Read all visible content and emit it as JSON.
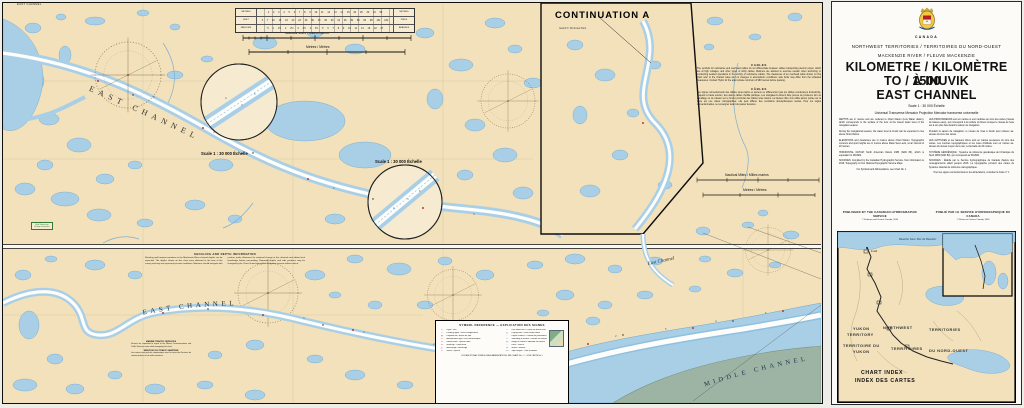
{
  "colors": {
    "land": "#f2e1ba",
    "water": "#a9cfe7",
    "water_edge": "#6fa5c9",
    "channel_white": "#fdfdfb",
    "island_green": "#9db4a4",
    "border_black": "#101010",
    "light_red": "#c0392b",
    "note_green": "#2e7d32"
  },
  "main_chart": {
    "edge_note": "EAST CHANNEL",
    "continuation_label": "CONTINUATION A",
    "park_label": "Gwich'in Territorial Park",
    "channel_labels": {
      "top": "EAST CHANNEL",
      "bottom": "EAST CHANNEL",
      "bottom_small": "East Channel",
      "middle": "MIDDLE CHANNEL"
    },
    "magnifier_label_1": "Scale 1 : 30 000 Échelle",
    "magnifier_label_2": "Scale 1 : 30 000 Échelle",
    "scalebar_nm": "Nautical Miles / Milles marins",
    "scalebar_m": "Metres / Mètres",
    "conversion_table": {
      "rows": [
        {
          "left": "METRES",
          "cells": "1 2 3 4 5 6 7 8 9 10 11 12 13 14 15 20 25 30 40 50",
          "right": "METRES"
        },
        {
          "left": "FEET",
          "cells": "3 7 10 13 16 20 23 26 30 33 36 39 43 46 49 66 82 98 131 164",
          "right": "PIEDS"
        },
        {
          "left": "FATHOMS",
          "cells": "½ 1 1½ 2 2½ 3 3½ 4 4½ 5 6 7 8 9 10 11 14 16 22 27",
          "right": "BRASSES"
        }
      ]
    },
    "cables": {
      "title_en": "CABLES",
      "body_en": "The symbols for submarine and overhead cables do not differentiate between cables transporting electric power, which are at high voltages, and other types of utility cables. Mariners are advised to exercise caution when anchoring or conducting seabed operations in the vicinity of submarine cables. The clearances of an overhead cable shown on this chart refer to the charted value and no changes in atmospheric conditions; safe limits may differ from the indicated clearances. Contact Hydro for the approximate minimum of 999 metres before passing.",
      "title_fr": "CÂBLES",
      "body_fr": "Les signes conventionnels des câbles sous-marins et aériens ne différencient pas les câbles conducteurs d'électricité, lesquels à haute tension, des autres câbles d'utilité publique. Les navigateurs doivent faire preuve de prudence lors du mouillage ou de travaux sur le fond à proximité des câbles sous-marins. La hauteur libre d'un câble aérien portée sur la carte est une valeur cartographiée; elle peut différer des conditions atmosphériques réelles. Pour les règles conventionnelles, se renseigner avant de passer dessous."
    },
    "notes": {
      "shoaling_title": "SHOALING AND DEPTH INFORMATION",
      "shoaling_body": "Shoaling and frequent variations in the Mackenzie River channel depths can be expected. The depths shown on this chart were obtained at the time of the survey and may not represent present conditions. Mariners should navigate with caution, make allowance for continual change in the channels and obtain local knowledge before proceeding. Reported depths and aids positions may be changed by the Coast Guard during the navigation season without notice.",
      "traffic_title_en": "MARINE TRAFFIC SERVICES",
      "traffic_body_en": "Vessels are requested to report to the Marine Communications and Traffic Services centre while navigating this chart.",
      "traffic_title_fr": "SERVICES DU TRAFIC MARITIME",
      "traffic_body_fr": "Les navires sont priés de communiquer avec le centre des Services de communications et de trafic maritimes."
    },
    "green_box_line1": "Bird Sanctuary",
    "green_box_line2": "Refuge d'oiseaux",
    "legend": {
      "title": "SYMBOL REFERENCE — EXPLICATION DES SIGNES",
      "left": [
        {
          "s": "✶",
          "t": "Light / Feu"
        },
        {
          "s": "⌖",
          "t": "Leading lights / Feux d'alignement"
        },
        {
          "s": "▮",
          "t": "Daybeacon / Balise de jour"
        },
        {
          "s": "✈",
          "t": "Aeronautical light / Feu aéronautique"
        },
        {
          "s": "⚑",
          "t": "Radio mast / Pylône radio"
        },
        {
          "s": "●",
          "t": "Mooring / Corps-mort"
        },
        {
          "s": "⚓",
          "t": "Anchorage / Mouillage"
        },
        {
          "s": "✕",
          "t": "Wreck / Épave"
        }
      ],
      "right": [
        {
          "s": "—",
          "t": "Low water line / Laisse de basse mer"
        },
        {
          "s": "▒",
          "t": "Drying area / Zone asséchante"
        },
        {
          "s": "~",
          "t": "Depth contour / Courbe de profondeur"
        },
        {
          "s": "9",
          "t": "Sounding in metres / Sonde en mètres"
        },
        {
          "s": "(3)",
          "t": "Height in metres / Altitude en mètres"
        },
        {
          "s": "＊",
          "t": "Rock / Roche"
        },
        {
          "s": "ψ",
          "t": "Marsh / Marais"
        },
        {
          "s": "·127",
          "t": "Spot height / Cote d'altitude"
        }
      ],
      "footer": "FOR ADDITIONAL SYMBOLS AND ABBREVIATIONS, SEE CHART No. 1 — VOIR CARTE No 1"
    },
    "soundings": [
      {
        "x": 222,
        "y": 96,
        "v": "4"
      },
      {
        "x": 238,
        "y": 103,
        "v": "3"
      },
      {
        "x": 251,
        "y": 92,
        "v": "5"
      },
      {
        "x": 390,
        "y": 206,
        "v": "4"
      },
      {
        "x": 404,
        "y": 197,
        "v": "3"
      },
      {
        "x": 416,
        "y": 189,
        "v": "6"
      },
      {
        "x": 150,
        "y": 95,
        "v": "3"
      },
      {
        "x": 210,
        "y": 130,
        "v": "4"
      },
      {
        "x": 330,
        "y": 186,
        "v": "2"
      },
      {
        "x": 470,
        "y": 212,
        "v": "4"
      },
      {
        "x": 300,
        "y": 316,
        "v": "3"
      },
      {
        "x": 360,
        "y": 330,
        "v": "4"
      },
      {
        "x": 430,
        "y": 342,
        "v": "2"
      },
      {
        "x": 520,
        "y": 350,
        "v": "3"
      },
      {
        "x": 562,
        "y": 342,
        "v": "4"
      },
      {
        "x": 612,
        "y": 334,
        "v": "2"
      },
      {
        "x": 662,
        "y": 327,
        "v": "5"
      },
      {
        "x": 712,
        "y": 319,
        "v": "4"
      },
      {
        "x": 762,
        "y": 311,
        "v": "6"
      }
    ]
  },
  "title_panel": {
    "country": "CANADA",
    "territory": "NORTHWEST TERRITORIES / TERRITOIRES DU NORD-OUEST",
    "river": "MACKENZIE RIVER / FLEUVE MACKENZIE",
    "title_line1": "KILOMETRE / KILOMÈTRE 1500",
    "title_line2": "TO / À INUVIK",
    "title_line3": "EAST CHANNEL",
    "scale": "Scale 1 : 30 000 Échelle",
    "projection": "Universal Transverse Mercator Projection    Mercator transverse universelle",
    "paras_en": [
      "DEPTHS are in metres and are reduced to Chart Datum (Low Water datum), which corresponds to the surface of the river at the lowest water level of the navigation season.",
      "During the navigational season, the water level at Inuvik can be expected to rise above Chart Datum.",
      "ELEVATIONS and clearances are in metres above Chart Datum. Topographic contours and spot heights are in metres above Mean Sea Level, at an interval of 20 metres."
    ],
    "datum_en": "HORIZONTAL DATUM: North American Datum 1983 (NAD 83), which is equivalent to WGS84.",
    "sources_en": "SOURCES: Compiled by the Canadian Hydrographic Service, from information to 2016. Topography is from National Topographic Service Maps.",
    "symbols_en": "For Symbols and Abbreviations, see Chart No. 1",
    "paras_fr": [
      "LES PROFONDEURS sont en mètres et sont réduites au zéro des cartes (niveau de basses eaux), qui correspond à la surface du fleuve lorsque le niveau de l'eau est à son plus bas durant la saison de navigation.",
      "Pendant la saison de navigation, le niveau de l'eau à Inuvik peut s'élever au-dessus du zéro des cartes.",
      "LES ALTITUDES et les hauteurs libres sont en mètres au-dessus du zéro des cartes. Les courbes topographiques et les cotes d'altitude sont en mètres au-dessus du niveau moyen de la mer, à intervalle de 20 mètres."
    ],
    "datum_fr": "SYSTÈME GÉODÉSIQUE : Système de référence géodésique de l'Amérique du Nord 1983 (NAD 83), qui correspond au WGS84.",
    "sources_fr": "SOURCES : Établie par le Service hydrographique du Canada d'après des renseignements allant jusqu'à 2016. La topographie provient des cartes du Système national de référence cartographique.",
    "symbols_fr": "Pour les signes conventionnels et les abréviations, consulter la Carte n° 1",
    "published_en": "PUBLISHED BY THE CANADIAN HYDROGRAPHIC SERVICE",
    "copyright_en": "© Fisheries and Oceans Canada, 2016",
    "published_fr": "PUBLIÉ PAR LE SERVICE HYDROGRAPHIQUE DU CANADA",
    "copyright_fr": "© Pêches et Océans Canada, 2016"
  },
  "index_map": {
    "sea": "Beaufort Sea / Mer de Beaufort",
    "yukon1": "YUKON",
    "yukon2": "TERRITORY",
    "yukon3": "TERRITOIRE DU",
    "yukon4": "YUKON",
    "nwt1": "NORTHWEST",
    "nwt2": "TERRITORIES",
    "nwt3": "TERRITOIRES",
    "nwt4": "DU NORD-OUEST",
    "chart_index_1": "CHART INDEX",
    "chart_index_2": "INDEX DES CARTES",
    "town": "Inuvik"
  }
}
